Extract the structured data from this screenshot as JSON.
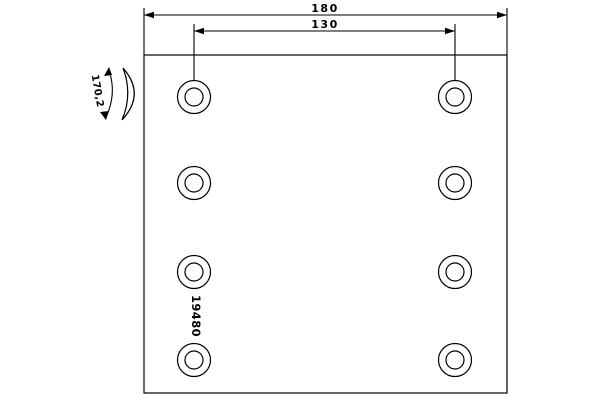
{
  "drawing": {
    "part_number": "19480",
    "dimensions": {
      "overall_width": "180",
      "hole_spacing": "130",
      "arc_dimension": "170,2"
    },
    "holes": {
      "columns": 2,
      "rows": 4,
      "total": 8
    },
    "colors": {
      "line": "#000000",
      "background": "#ffffff"
    }
  }
}
